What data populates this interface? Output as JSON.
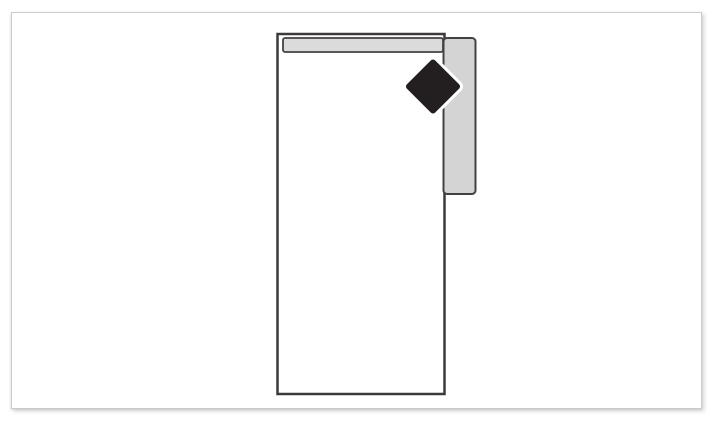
{
  "diagram": {
    "colors": {
      "canvas_bg": "#ffffff",
      "frame_bg": "#ffffff",
      "frame_border": "#cbcbcb",
      "unit_fill": "#ffffff",
      "unit_outline": "#3c3a3b",
      "rail_fill": "#dbdbdb",
      "side_rail_fill": "#d4d4d4",
      "rail_border": "#454142",
      "diamond_fill": "#231f20",
      "diamond_halo": "#ffffff"
    },
    "shapes": {
      "furniture_outline": {
        "x": 277.5,
        "y": 34,
        "width": 167,
        "height": 360,
        "rx": 0,
        "stroke_width": 2.5
      },
      "top_rail": {
        "x": 283,
        "y": 38,
        "width": 160,
        "height": 14,
        "rx": 2,
        "stroke_width": 1.8
      },
      "side_rail": {
        "x": 443.5,
        "y": 38,
        "width": 32,
        "height": 156,
        "rx": 3.5,
        "stroke_width": 2
      },
      "diamond_marker": {
        "x": 413,
        "y": 66.5,
        "width": 40,
        "height": 40,
        "rx": 3,
        "transform": "rotate(45 433 86.5)",
        "stroke_width": 6
      }
    }
  }
}
